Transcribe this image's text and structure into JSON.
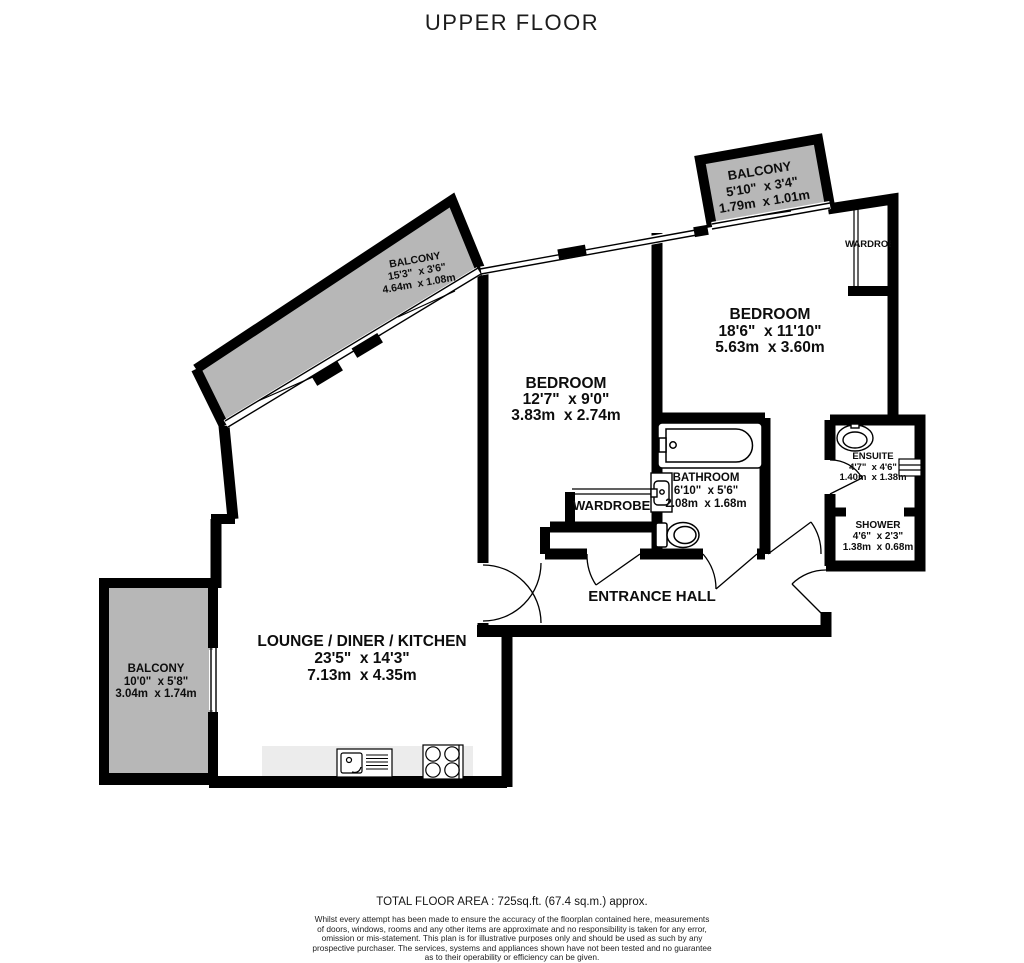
{
  "title": "UPPER FLOOR",
  "rooms": {
    "balcony_top": {
      "name": "BALCONY",
      "imperial": "5'10\"  x 3'4\"",
      "metric": "1.79m  x 1.01m"
    },
    "balcony_diagonal": {
      "name": "BALCONY",
      "imperial": "15'3\"  x 3'6\"",
      "metric": "4.64m  x 1.08m"
    },
    "balcony_left": {
      "name": "BALCONY",
      "imperial": "10'0\"  x 5'8\"",
      "metric": "3.04m  x 1.74m"
    },
    "bedroom_main": {
      "name": "BEDROOM",
      "imperial": "18'6\"  x 11'10\"",
      "metric": "5.63m  x 3.60m"
    },
    "bedroom_second": {
      "name": "BEDROOM",
      "imperial": "12'7\"  x 9'0\"",
      "metric": "3.83m  x 2.74m"
    },
    "bathroom": {
      "name": "BATHROOM",
      "imperial": "6'10\"  x 5'6\"",
      "metric": "2.08m  x 1.68m"
    },
    "ensuite": {
      "name": "ENSUITE",
      "imperial": "4'7\"  x 4'6\"",
      "metric": "1.40m  x 1.38m"
    },
    "shower": {
      "name": "SHOWER",
      "imperial": "4'6\"  x 2'3\"",
      "metric": "1.38m  x 0.68m"
    },
    "entrance_hall": {
      "name": "ENTRANCE HALL"
    },
    "lounge": {
      "name": "LOUNGE / DINER / KITCHEN",
      "imperial": "23'5\"  x 14'3\"",
      "metric": "7.13m  x 4.35m"
    },
    "wardrobe_main": {
      "name": "WARDROBE"
    },
    "wardrobe_hall": {
      "name": "WARDROBE"
    }
  },
  "footer": {
    "total_area": "TOTAL FLOOR AREA : 725sq.ft. (67.4 sq.m.) approx.",
    "disclaimer": [
      "Whilst every attempt has been made to ensure the accuracy of the floorplan contained here, measurements",
      "of doors, windows, rooms and any other items are approximate and no responsibility is taken for any error,",
      "omission or mis-statement. This plan is for illustrative purposes only and should be used as such by any",
      "prospective purchaser. The services, systems and appliances shown have not been tested and no guarantee",
      "as to their operability or efficiency can be given."
    ],
    "credit": "Made with Metropix ©2026"
  },
  "colors": {
    "wall": "#000000",
    "balcony_fill": "#b7b7b7",
    "counter_fill": "#ececec",
    "text": "#111111"
  }
}
